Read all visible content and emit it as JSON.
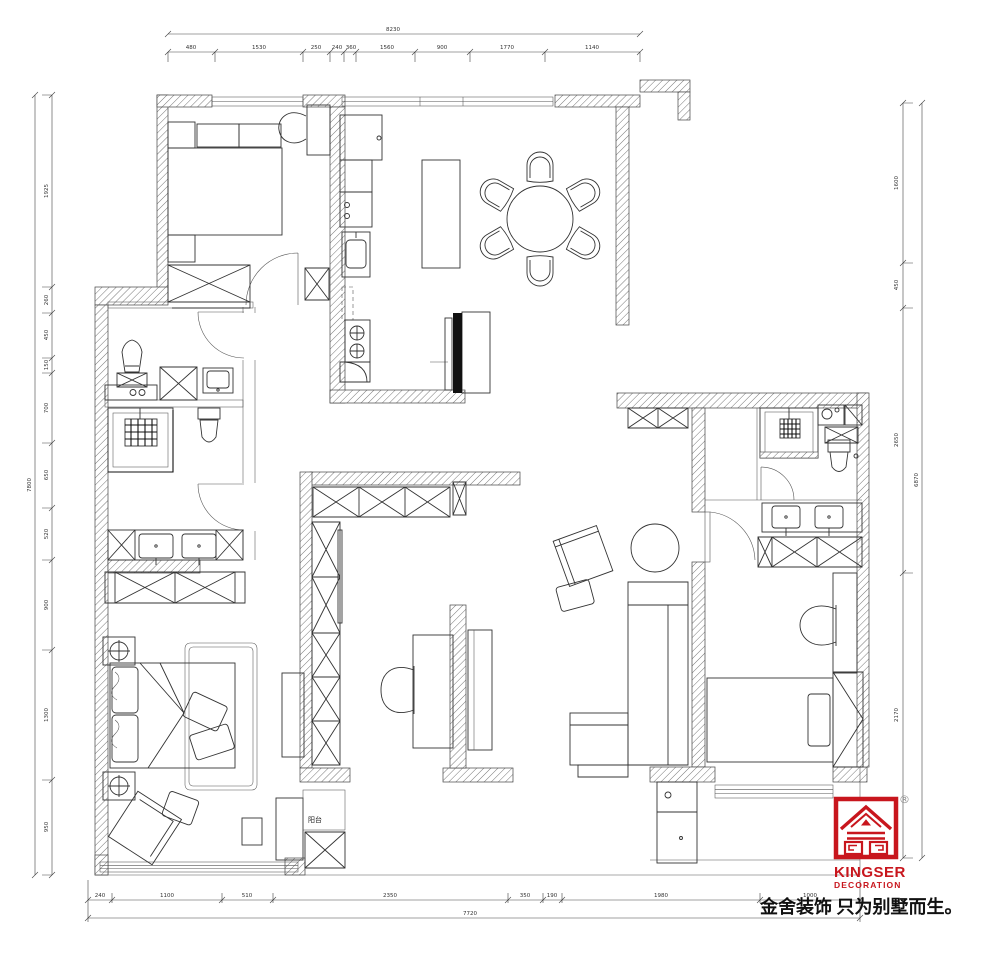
{
  "page": {
    "background": "#ffffff"
  },
  "branding": {
    "logo_brand": "KINGSER",
    "logo_division": "DECORATION",
    "registered_mark": "®",
    "brand_color": "#c8161d",
    "tagline": "金舍装饰 只为别墅而生。"
  },
  "plan_labels": {
    "small_room_label": "阳台"
  },
  "dimensions": {
    "top": {
      "total": "8230",
      "segments": [
        "480",
        "1530",
        "250",
        "240",
        "360",
        "1560",
        "900",
        "1770",
        "1140"
      ]
    },
    "left": {
      "total": "7800",
      "segments": [
        "1925",
        "260",
        "450",
        "150",
        "700",
        "650",
        "520",
        "900",
        "1300",
        "950"
      ]
    },
    "right": {
      "total": "6870",
      "segments": [
        "1600",
        "450",
        "2650",
        "2170"
      ]
    },
    "bottom": {
      "total": "7720",
      "segments": [
        "240",
        "1100",
        "510",
        "2350",
        "350",
        "190",
        "1980",
        "1000"
      ]
    }
  }
}
